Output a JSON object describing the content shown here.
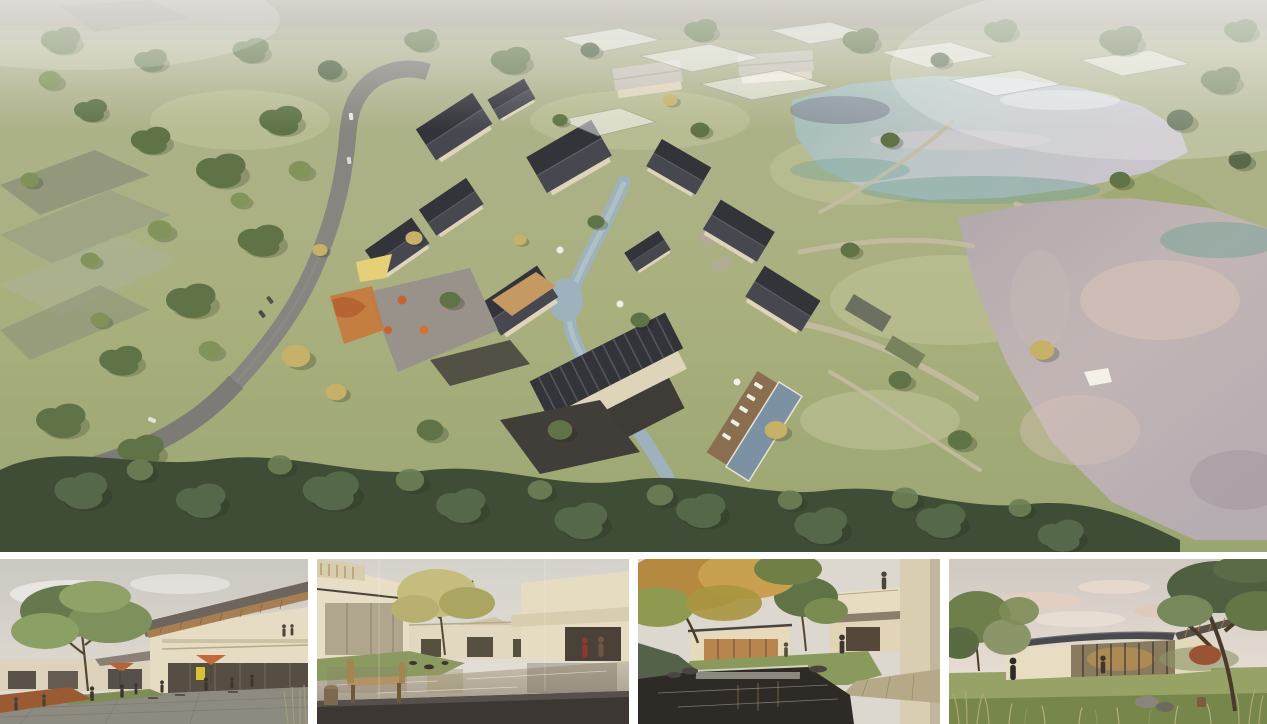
{
  "document": {
    "title": "Architectural rendering presentation board — lakeside courtyard-village resort",
    "visible_text": "none"
  },
  "panels": {
    "aerial": {
      "name": "aerial-masterplan-render",
      "description": "Bird's-eye rendering of a village of cream-walled, dark-gable-roofed courtyard houses arranged along a winding stream, with a cafe plaza, playground, swimming pool with timber deck, footpaths to two large reflective lakes on the right, a curving gray access road with cars on the left, translucent ghost massing of future phases at the top, and dense green tree cover"
    },
    "thumbnails": [
      {
        "name": "street-scene-render",
        "description": "Eye-level view of a pedestrian retail lane: two-storey cream building with deep timber-soffit roof and balcony on the right, cafe umbrellas and seated people, large green tree and corten planter on the left"
      },
      {
        "name": "reflecting-pond-courtyard-render",
        "description": "Courtyard with a still reflecting pond between cream flat-roofed houses, a golden-leafed tree, a wooden bench on a dark stone terrace in the foreground and two figures walking at right"
      },
      {
        "name": "waterfall-garden-courtyard-render",
        "description": "Garden courtyard with an autumn-gold tree canopy, low cream pavilions with warm glazing, a cantilevered balcony volume at right with a person above, stone walkway and a dark pond with a small waterfall weir in the foreground"
      },
      {
        "name": "lakeside-pavilion-render",
        "description": "Long single-storey glass pavilion with a thin dark floating roof and timber rafters under a soft pink-clouded sky, framed by an olive tree cluster at left and a large leaning tree at right, tall dry grasses and rocks in the foreground"
      }
    ]
  },
  "colors": {
    "gutter": "#ffffff",
    "grass": "#a9b07e",
    "grass_light": "#c3c69b",
    "tree_dark": "#44543b",
    "tree_mid": "#5f7347",
    "tree_light": "#7e9156",
    "tree_gold": "#c7b169",
    "roof_dark": "#35353b",
    "wall_cream": "#ded4ba",
    "lake_upper": "#b4c2bf",
    "lake_lower": "#b9aeb0",
    "water_teal": "#74a296",
    "water_pink": "#d9c2b8",
    "pool_blue": "#7c91a3",
    "road_gray": "#86857f",
    "path_beige": "#c6bda4",
    "accent_orange": "#c4652f",
    "sky": "#d6d2cb",
    "deck_wood": "#8a6e50",
    "stone_dark": "#3c3733"
  }
}
